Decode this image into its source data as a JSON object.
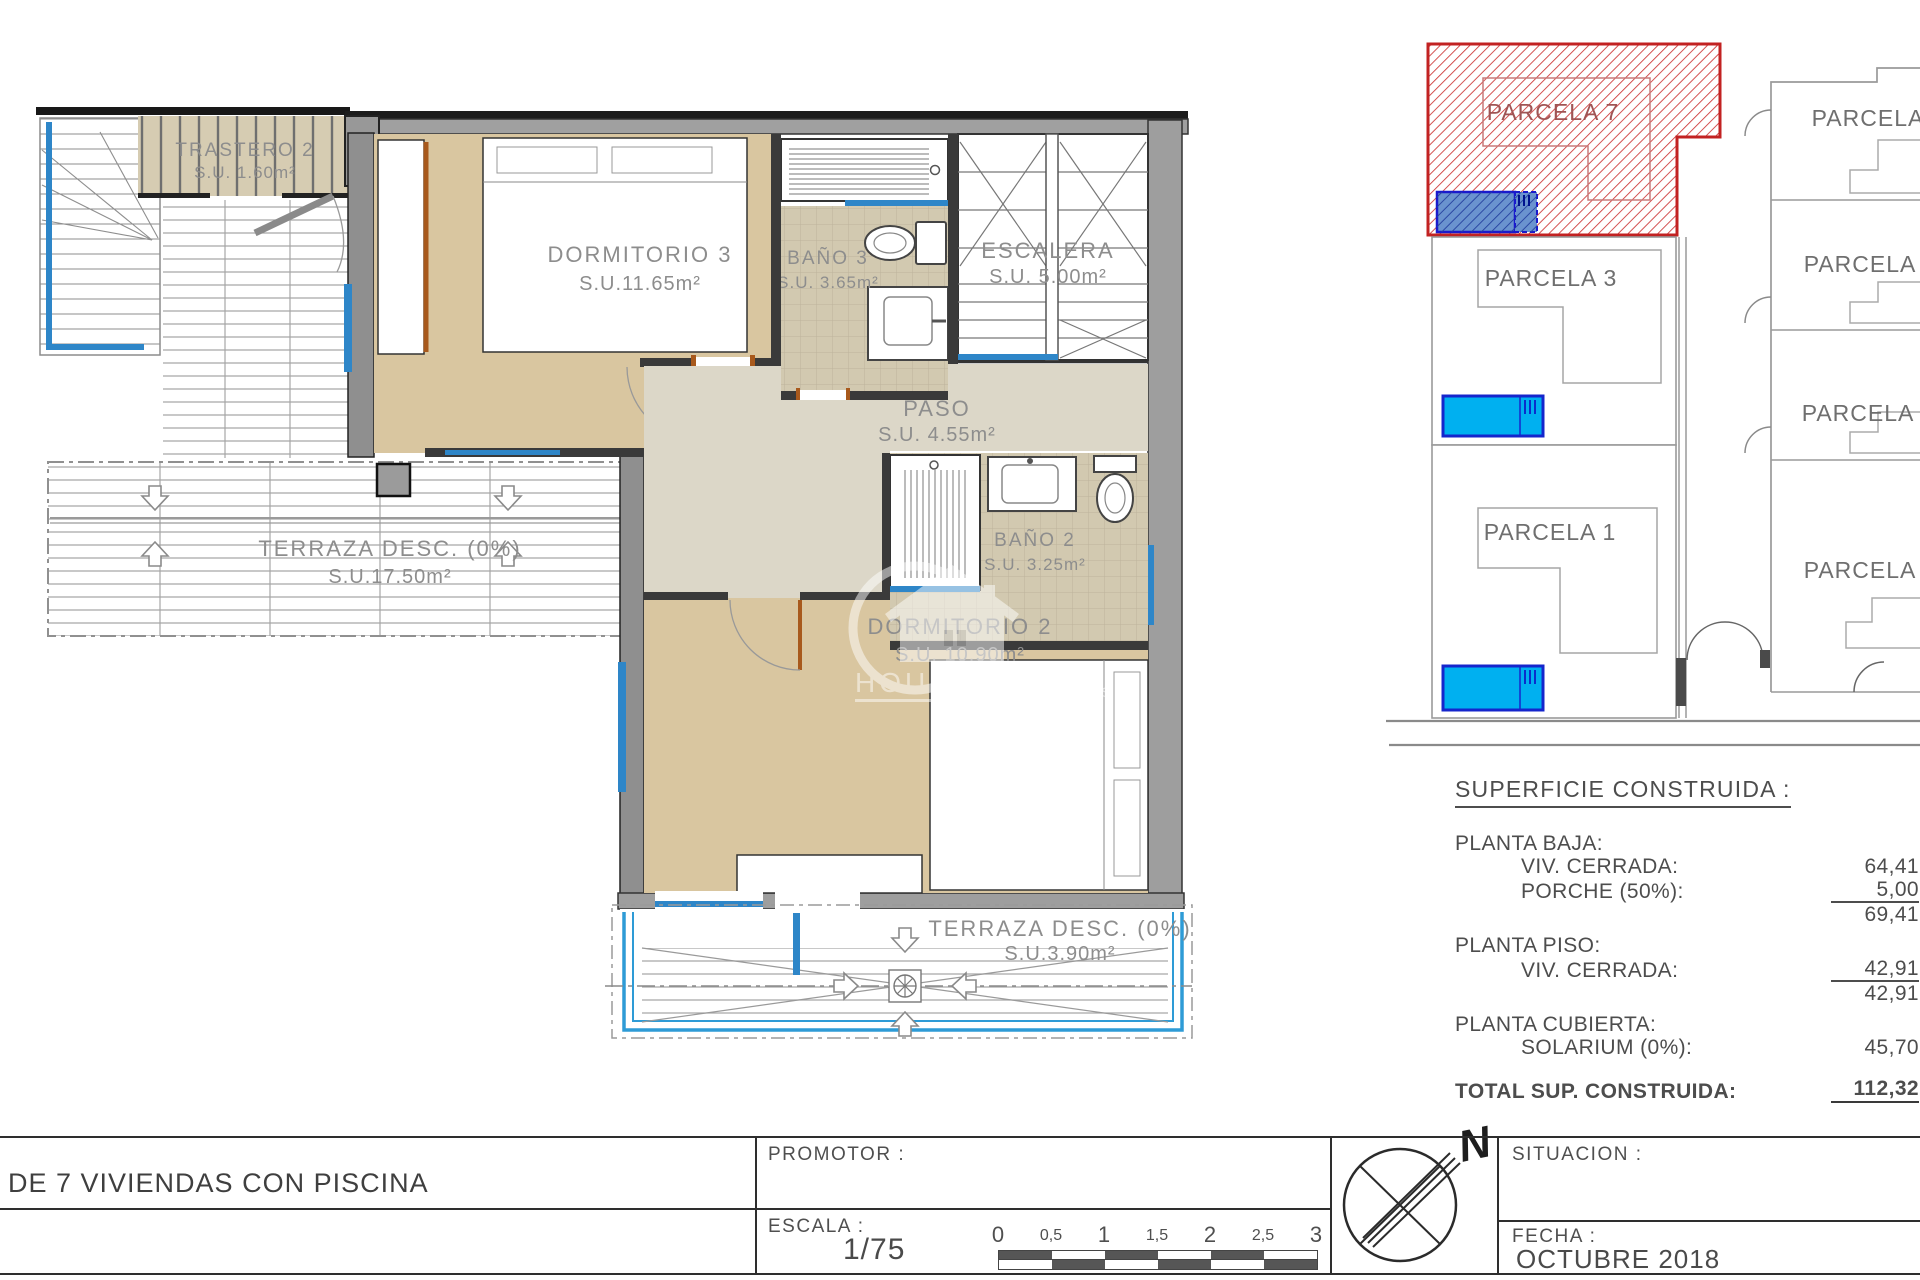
{
  "floorplan": {
    "rooms": [
      {
        "name": "TRASTERO 2",
        "area": "S.U. 1.60m²"
      },
      {
        "name": "DORMITORIO 3",
        "area": "S.U.11.65m²"
      },
      {
        "name": "BAÑO 3",
        "area": "S.U. 3.65m²"
      },
      {
        "name": "ESCALERA",
        "area": "S.U. 5.00m²"
      },
      {
        "name": "PASO",
        "area": "S.U. 4.55m²"
      },
      {
        "name": "BAÑO 2",
        "area": "S.U. 3.25m²"
      },
      {
        "name": "DORMITORIO 2",
        "area": "S.U. 10.90m²"
      },
      {
        "name": "TERRAZA DESC. (0%)",
        "area": "S.U.17.50m²"
      },
      {
        "name": "TERRAZA DESC. (0%)",
        "area": "S.U.3.90m²"
      }
    ],
    "watermark": {
      "line1": "HOUSE IN",
      "line2": "REAL ES"
    }
  },
  "siteplan": {
    "parcels": [
      {
        "label": "PARCELA 7"
      },
      {
        "label": "PARCELA 3"
      },
      {
        "label": "PARCELA 1"
      },
      {
        "label": "PARCELA"
      },
      {
        "label": "PARCELA 5"
      },
      {
        "label": "PARCELA 4"
      },
      {
        "label": "PARCELA 2"
      }
    ],
    "colors": {
      "highlight": "#c22222",
      "pool": "#00b0f0",
      "pool_hatched": "#6a93cf"
    }
  },
  "surface_table": {
    "title": "SUPERFICIE CONSTRUIDA :",
    "sections": [
      {
        "heading": "PLANTA BAJA:",
        "rows": [
          {
            "label": "VIV. CERRADA:",
            "value": "64,41"
          },
          {
            "label": "PORCHE (50%):",
            "value": "5,00"
          }
        ],
        "subtotal": "69,41"
      },
      {
        "heading": "PLANTA PISO:",
        "rows": [
          {
            "label": "VIV. CERRADA:",
            "value": "42,91"
          }
        ],
        "subtotal": "42,91"
      },
      {
        "heading": "PLANTA CUBIERTA:",
        "rows": [
          {
            "label": "SOLARIUM (0%):",
            "value": "45,70"
          }
        ]
      }
    ],
    "total_label": "TOTAL SUP. CONSTRUIDA:",
    "total_value": "112,32"
  },
  "titleblock": {
    "project_title": "DE 7 VIVIENDAS CON PISCINA",
    "promotor_label": "PROMOTOR :",
    "escala_label": "ESCALA :",
    "escala_value": "1/75",
    "scale_ticks": [
      "0",
      "0,5",
      "1",
      "1,5",
      "2",
      "2,5",
      "3"
    ],
    "situacion_label": "SITUACION :",
    "fecha_label": "FECHA :",
    "fecha_value": "OCTUBRE 2018",
    "north_label": "N"
  }
}
